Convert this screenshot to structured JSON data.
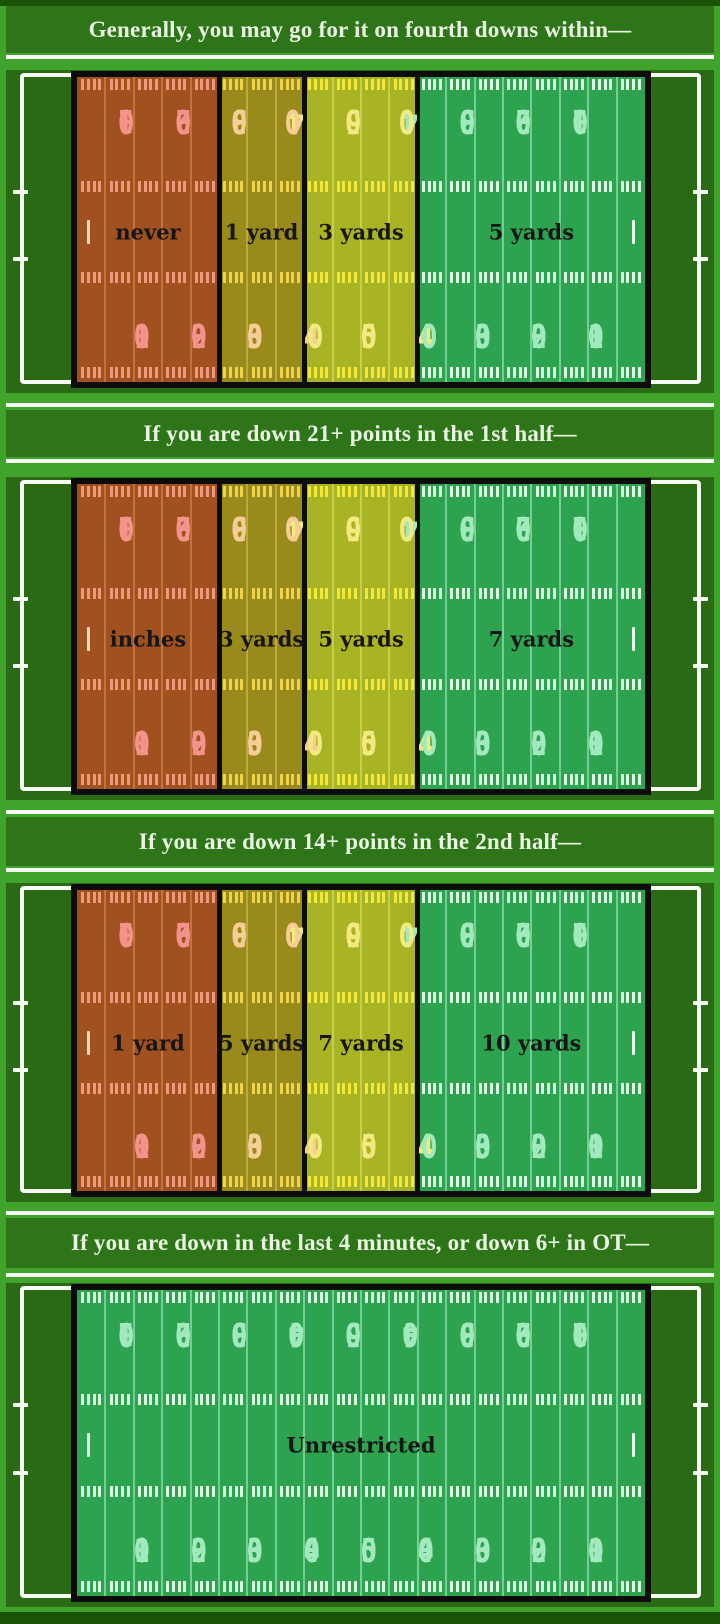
{
  "palette": {
    "page_bg": "#3FA32C",
    "edge_strip": "#1A5306",
    "title_bar_bg": "#2E7418",
    "title_text": "#E9F5E2",
    "field_bg": "#2A6A14",
    "sideline_white": "#F6FBF4",
    "zone_border_black": "#0C0C0C",
    "zone_label_text": "#161616",
    "zone_colors": {
      "red": {
        "bg": "#A1511F",
        "line": "#C3793F",
        "tick": "#F0997B",
        "num": "#F3938C",
        "goal": "#F6D9BE"
      },
      "olive": {
        "bg": "#998A1C",
        "line": "#BFAE44",
        "tick": "#EFD34A",
        "num": "#F6CD96",
        "goal": "#F6E9B8"
      },
      "yellow": {
        "bg": "#A9B424",
        "line": "#CBD254",
        "tick": "#F1E83C",
        "num": "#F2EA80",
        "goal": "#FBF6C0"
      },
      "green": {
        "bg": "#2DA34F",
        "line": "#7BD49C",
        "tick": "#D9F6E0",
        "num": "#A2EABE",
        "goal": "#E8FAEE"
      }
    }
  },
  "yard_numbers": [
    {
      "yd": 10,
      "text": "10"
    },
    {
      "yd": 20,
      "text": "20"
    },
    {
      "yd": 30,
      "text": "30"
    },
    {
      "yd": 40,
      "text": "40"
    },
    {
      "yd": 50,
      "text": "50"
    },
    {
      "yd": 60,
      "text": "40"
    },
    {
      "yd": 70,
      "text": "30"
    },
    {
      "yd": 80,
      "text": "20"
    },
    {
      "yd": 90,
      "text": "10"
    }
  ],
  "panels": [
    {
      "title": "Generally, you may go for it on fourth downs within—",
      "zones": [
        {
          "from": 0,
          "to": 25,
          "color": "red",
          "label": "never"
        },
        {
          "from": 25,
          "to": 40,
          "color": "olive",
          "label": "1 yard"
        },
        {
          "from": 40,
          "to": 60,
          "color": "yellow",
          "label": "3 yards"
        },
        {
          "from": 60,
          "to": 100,
          "color": "green",
          "label": "5 yards"
        }
      ]
    },
    {
      "title": "If you are down 21+ points in the 1st half—",
      "zones": [
        {
          "from": 0,
          "to": 25,
          "color": "red",
          "label": "inches"
        },
        {
          "from": 25,
          "to": 40,
          "color": "olive",
          "label": "3 yards"
        },
        {
          "from": 40,
          "to": 60,
          "color": "yellow",
          "label": "5 yards"
        },
        {
          "from": 60,
          "to": 100,
          "color": "green",
          "label": "7 yards"
        }
      ]
    },
    {
      "title": "If you are down 14+ points in the 2nd half—",
      "zones": [
        {
          "from": 0,
          "to": 25,
          "color": "red",
          "label": "1 yard"
        },
        {
          "from": 25,
          "to": 40,
          "color": "olive",
          "label": "5 yards"
        },
        {
          "from": 40,
          "to": 60,
          "color": "yellow",
          "label": "7 yards"
        },
        {
          "from": 60,
          "to": 100,
          "color": "green",
          "label": "10 yards"
        }
      ]
    },
    {
      "title": "If you are down in the last 4 minutes, or down 6+ in OT—",
      "zones": [
        {
          "from": 0,
          "to": 100,
          "color": "green",
          "label": "Unrestricted"
        }
      ]
    }
  ],
  "chart_data": {
    "type": "heatmap",
    "title": "When to go for it on fourth down, by field position (own goal line = 0, opponent goal line = 100)",
    "x": "field position (yards from own goal line)",
    "categories": [
      "0-25 yd (own territory)",
      "25-40 yd",
      "40-60 yd (midfield)",
      "60-100 yd (opponent territory)"
    ],
    "series": [
      {
        "name": "Generally, you may go for it on fourth downs within—",
        "values": [
          "never",
          "1 yard",
          "3 yards",
          "5 yards"
        ]
      },
      {
        "name": "If you are down 21+ points in the 1st half—",
        "values": [
          "inches",
          "3 yards",
          "5 yards",
          "7 yards"
        ]
      },
      {
        "name": "If you are down 14+ points in the 2nd half—",
        "values": [
          "1 yard",
          "5 yards",
          "7 yards",
          "10 yards"
        ]
      },
      {
        "name": "If you are down in the last 4 minutes, or down 6+ in OT—",
        "values": [
          "Unrestricted",
          "Unrestricted",
          "Unrestricted",
          "Unrestricted"
        ]
      }
    ],
    "legend_colors": {
      "red": "most restrictive",
      "olive": "restrictive",
      "yellow": "moderate",
      "green": "least restrictive"
    }
  }
}
